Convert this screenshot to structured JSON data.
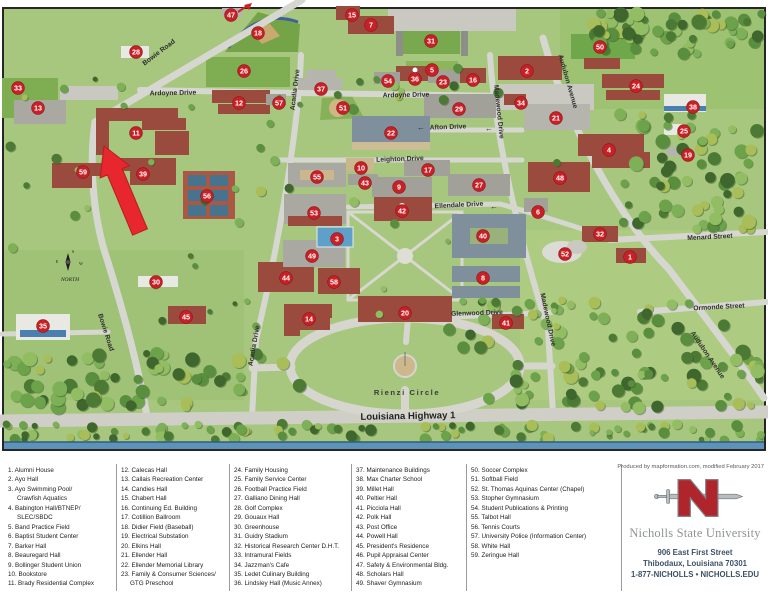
{
  "map": {
    "marker_color": "#c62127",
    "compass_label": "NORTH",
    "markers": [
      {
        "n": 1,
        "x": 630,
        "y": 257
      },
      {
        "n": 2,
        "x": 527,
        "y": 71
      },
      {
        "n": 3,
        "x": 337,
        "y": 239
      },
      {
        "n": 4,
        "x": 609,
        "y": 150
      },
      {
        "n": 5,
        "x": 432,
        "y": 70
      },
      {
        "n": 6,
        "x": 538,
        "y": 212
      },
      {
        "n": 7,
        "x": 371,
        "y": 25
      },
      {
        "n": 8,
        "x": 483,
        "y": 278
      },
      {
        "n": 9,
        "x": 399,
        "y": 187
      },
      {
        "n": 10,
        "x": 361,
        "y": 168
      },
      {
        "n": 11,
        "x": 136,
        "y": 133
      },
      {
        "n": 12,
        "x": 239,
        "y": 103
      },
      {
        "n": 13,
        "x": 38,
        "y": 108
      },
      {
        "n": 14,
        "x": 309,
        "y": 319
      },
      {
        "n": 15,
        "x": 352,
        "y": 15
      },
      {
        "n": 16,
        "x": 473,
        "y": 80
      },
      {
        "n": 17,
        "x": 428,
        "y": 170
      },
      {
        "n": 18,
        "x": 258,
        "y": 33
      },
      {
        "n": 19,
        "x": 688,
        "y": 155
      },
      {
        "n": 20,
        "x": 405,
        "y": 313
      },
      {
        "n": 21,
        "x": 556,
        "y": 118
      },
      {
        "n": 22,
        "x": 391,
        "y": 133
      },
      {
        "n": 23,
        "x": 443,
        "y": 82
      },
      {
        "n": 24,
        "x": 636,
        "y": 86
      },
      {
        "n": 25,
        "x": 684,
        "y": 131
      },
      {
        "n": 26,
        "x": 244,
        "y": 71
      },
      {
        "n": 27,
        "x": 479,
        "y": 185
      },
      {
        "n": 28,
        "x": 136,
        "y": 52
      },
      {
        "n": 29,
        "x": 459,
        "y": 109
      },
      {
        "n": 30,
        "x": 156,
        "y": 282
      },
      {
        "n": 31,
        "x": 431,
        "y": 41
      },
      {
        "n": 32,
        "x": 600,
        "y": 234
      },
      {
        "n": 33,
        "x": 18,
        "y": 88
      },
      {
        "n": 34,
        "x": 521,
        "y": 103
      },
      {
        "n": 35,
        "x": 43,
        "y": 326
      },
      {
        "n": 36,
        "x": 415,
        "y": 79
      },
      {
        "n": 37,
        "x": 321,
        "y": 89
      },
      {
        "n": 38,
        "x": 693,
        "y": 107
      },
      {
        "n": 39,
        "x": 143,
        "y": 174
      },
      {
        "n": 40,
        "x": 483,
        "y": 236
      },
      {
        "n": 41,
        "x": 506,
        "y": 323
      },
      {
        "n": 42,
        "x": 402,
        "y": 211
      },
      {
        "n": 43,
        "x": 365,
        "y": 183
      },
      {
        "n": 44,
        "x": 286,
        "y": 278
      },
      {
        "n": 45,
        "x": 186,
        "y": 317
      },
      {
        "n": 47,
        "x": 231,
        "y": 15
      },
      {
        "n": 48,
        "x": 560,
        "y": 178
      },
      {
        "n": 49,
        "x": 312,
        "y": 256
      },
      {
        "n": 50,
        "x": 600,
        "y": 47
      },
      {
        "n": 51,
        "x": 343,
        "y": 108
      },
      {
        "n": 52,
        "x": 565,
        "y": 254
      },
      {
        "n": 53,
        "x": 314,
        "y": 213
      },
      {
        "n": 54,
        "x": 388,
        "y": 81
      },
      {
        "n": 55,
        "x": 317,
        "y": 177
      },
      {
        "n": 56,
        "x": 207,
        "y": 196
      },
      {
        "n": 57,
        "x": 279,
        "y": 103
      },
      {
        "n": 58,
        "x": 334,
        "y": 282
      },
      {
        "n": 59,
        "x": 83,
        "y": 172
      }
    ],
    "road_labels": [
      {
        "t": "Bowie Road",
        "x": 160,
        "y": 54,
        "a": -37
      },
      {
        "t": "Bowie Road",
        "x": 104,
        "y": 333,
        "a": 72
      },
      {
        "t": "Ardoyne Drive",
        "x": 173,
        "y": 95,
        "a": -1
      },
      {
        "t": "Ardoyne Drive",
        "x": 406,
        "y": 97,
        "a": -1
      },
      {
        "t": "Afton Drive",
        "x": 448,
        "y": 129,
        "a": -2
      },
      {
        "t": "Leighton Drive",
        "x": 400,
        "y": 161,
        "a": -2
      },
      {
        "t": "Ellendale Drive",
        "x": 459,
        "y": 207,
        "a": -3
      },
      {
        "t": "Glenwood Drive",
        "x": 477,
        "y": 315,
        "a": -2
      },
      {
        "t": "Menard Street",
        "x": 710,
        "y": 239,
        "a": -3
      },
      {
        "t": "Ormonde Street",
        "x": 719,
        "y": 309,
        "a": -3
      },
      {
        "t": "Rienzi Circle",
        "x": 407,
        "y": 395,
        "a": 0,
        "cls": "wide"
      },
      {
        "t": "Louisiana Highway 1",
        "x": 408,
        "y": 419,
        "a": -1,
        "cls": "big"
      },
      {
        "t": "Acadia Drive",
        "x": 297,
        "y": 90,
        "a": -83
      },
      {
        "t": "Acadia Drive",
        "x": 256,
        "y": 346,
        "a": -80
      },
      {
        "t": "Madewood Drive",
        "x": 497,
        "y": 112,
        "a": 84
      },
      {
        "t": "Madewood Drive",
        "x": 546,
        "y": 320,
        "a": 78
      },
      {
        "t": "Audubon Avenue",
        "x": 566,
        "y": 82,
        "a": 74
      },
      {
        "t": "Audubon Avenue",
        "x": 706,
        "y": 356,
        "a": 56
      },
      {
        "t": "←",
        "x": 494,
        "y": 209,
        "a": 0,
        "cls": "arr"
      },
      {
        "t": "←",
        "x": 421,
        "y": 130,
        "a": 0,
        "cls": "arr"
      },
      {
        "t": "←",
        "x": 489,
        "y": 131,
        "a": 0,
        "cls": "arr"
      }
    ]
  },
  "legend": {
    "columns": [
      [
        "1. Alumni House",
        "2. Ayo Hall",
        "3. Ayo Swimming Pool/\nCrawfish Aquatics",
        "4. Babington Hall/BTNEP/\nSLEC/SBDC",
        "5. Band Practice Field",
        "6. Baptist Student Center",
        "7. Barker Hall",
        "8. Beauregard Hall",
        "9. Bollinger Student Union",
        "10. Bookstore",
        "11. Brady Residential Complex"
      ],
      [
        "12. Calecas Hall",
        "13. Callais Recreation Center",
        "14. Candies Hall",
        "15. Chabert Hall",
        "16. Continuing Ed. Building",
        "17. Cotillion Ballroom",
        "18. Didier Field (Baseball)",
        "19. Electrical Substation",
        "20. Elkins Hall",
        "21. Ellender Hall",
        "22. Ellender Memorial Library",
        "23. Family & Consumer Sciences/\nGTG Preschool"
      ],
      [
        "24. Family Housing",
        "25. Family Service Center",
        "26. Football Practice Field",
        "27. Galliano Dining Hall",
        "28. Golf Complex",
        "29. Gouaux Hall",
        "30. Greenhouse",
        "31. Guidry Stadium",
        "32. Historical Research Center D.H.T.",
        "33. Intramural Fields",
        "34. Jazzman's Cafe",
        "35. Ledet Culinary Building",
        "36. Lindsley Hall (Music Annex)"
      ],
      [
        "37. Maintenance Buildings",
        "38. Max Charter School",
        "39. Millet Hall",
        "40. Peltier Hall",
        "41. Picciola Hall",
        "42. Polk Hall",
        "43. Post Office",
        "44. Powell Hall",
        "45. President's Residence",
        "46. Pupil Appraisal Center",
        "47. Safety & Environmental Bldg.",
        "48. Scholars Hall",
        "49. Shaver Gymnasium"
      ],
      [
        "50. Soccer Complex",
        "51. Softball Field",
        "52. St. Thomas Aquinas Center (Chapel)",
        "53. Stopher Gymnasium",
        "54. Student Publications & Printing",
        "55. Talbot Hall",
        "56. Tennis Courts",
        "57. University Police (Information Center)",
        "58. White Hall",
        "59. Zeringue Hall"
      ]
    ]
  },
  "footer": {
    "credit": "Produced by mapformation.com, modified February 2017",
    "university": "Nicholls State University",
    "address_line1": "906 East First Street",
    "address_line2": "Thibodaux, Louisiana 70301",
    "address_line3": "1-877-NICHOLLS • NICHOLLS.EDU"
  }
}
